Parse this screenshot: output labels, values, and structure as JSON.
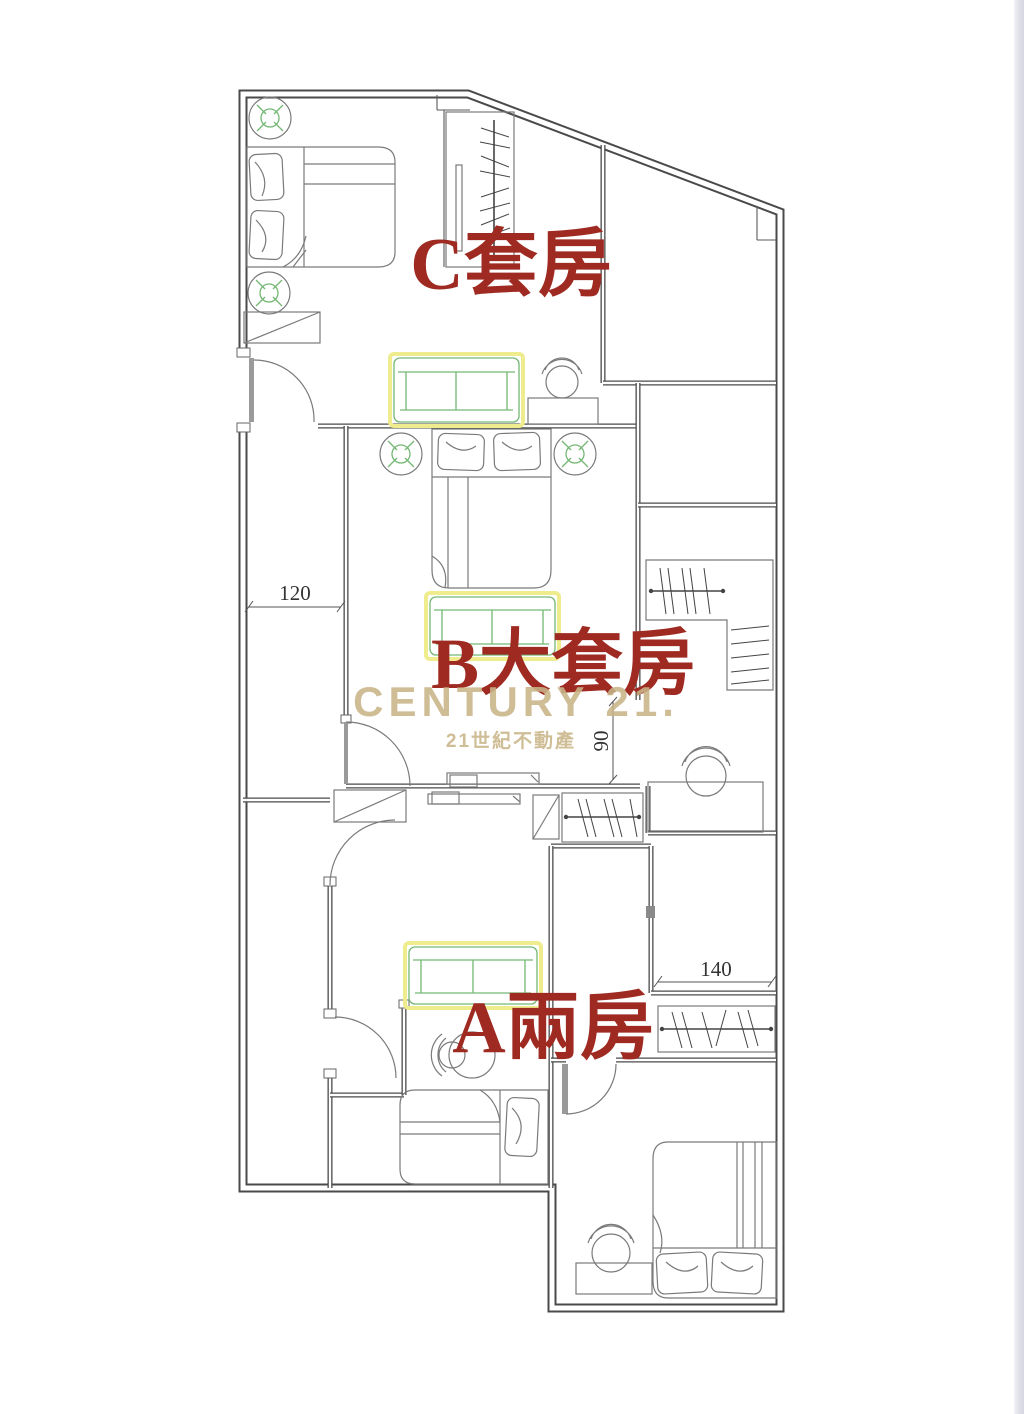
{
  "page": {
    "background": "#ffffff",
    "right_edge_strip_color": "#d5d6df"
  },
  "floorplan": {
    "rooms": [
      {
        "id": "C",
        "label": "C套房"
      },
      {
        "id": "B",
        "label": "B大套房"
      },
      {
        "id": "A",
        "label": "A兩房"
      }
    ],
    "dimensions": [
      {
        "value": "120",
        "orientation": "horizontal",
        "location": "corridor"
      },
      {
        "value": "90",
        "orientation": "vertical",
        "location": "b-bathroom-opening"
      },
      {
        "value": "140",
        "orientation": "horizontal",
        "location": "a-closet"
      }
    ],
    "watermark": {
      "brand": "CENTURY 21.",
      "subtitle": "21世紀不動產"
    },
    "colors": {
      "label_red": "#9f2a22",
      "watermark_tan": "#c9b488",
      "wall_line": "#4a4a4a",
      "furniture_line": "#7a7a7a",
      "accent_green": "#74b874",
      "highlight_yellow": "#efec8e"
    }
  }
}
